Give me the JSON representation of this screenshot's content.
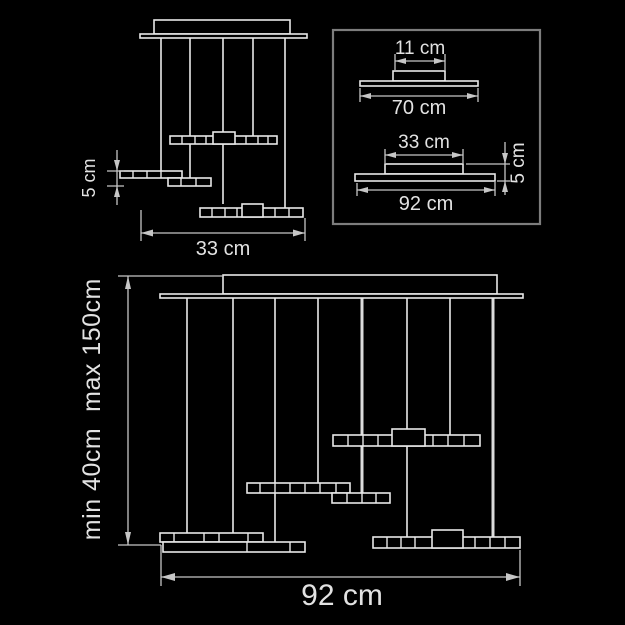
{
  "figure_title": "pendant suspension light dimension drawing",
  "colors": {
    "background": "#000000",
    "drawing_line": "#e8e8e8",
    "dimension_line": "#c6c6c6",
    "text": "#e2e2e2",
    "inset_border": "#7d7d7d"
  },
  "small_front_view": {
    "thickness_label": "5 cm",
    "width_label": "33 cm"
  },
  "detail_inset": {
    "top_profile": {
      "box_width_label": "11 cm",
      "plate_width_label": "70 cm"
    },
    "side_profile": {
      "box_width_label": "33 cm",
      "plate_width_label": "92 cm",
      "thickness_label": "5 cm"
    }
  },
  "large_front_view": {
    "min_drop_label": "min 40cm",
    "max_drop_label": "max 150cm",
    "width_label": "92 cm"
  }
}
